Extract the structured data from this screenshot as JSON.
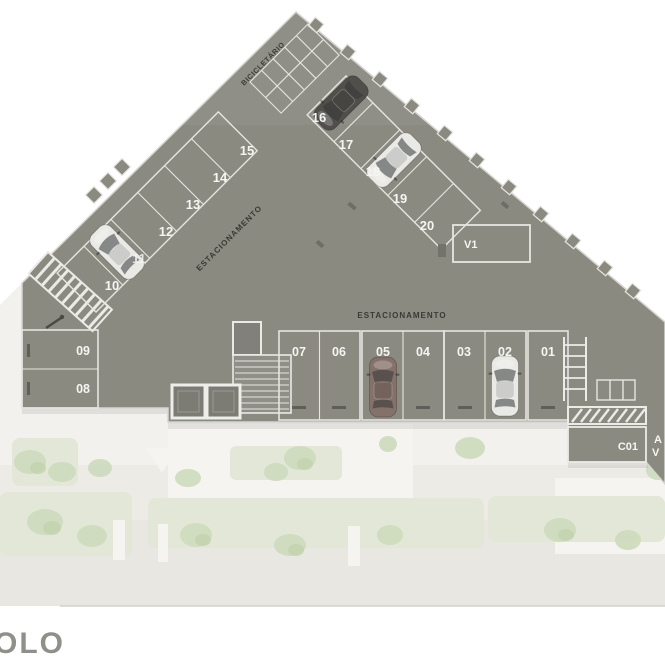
{
  "plan": {
    "caption_partial": "OLO",
    "labels": {
      "parking_diagonal": "ESTACIONAMENTO",
      "parking_horizontal": "ESTACIONAMENTO",
      "bike_storage": "BICICLETÁRIO",
      "v1": "V1",
      "c01": "C01",
      "edge_partial_line1": "A",
      "edge_partial_line2": "V"
    },
    "stalls": {
      "bottom_row": [
        "07",
        "06",
        "05",
        "04",
        "03",
        "02",
        "01"
      ],
      "left_block": [
        "09",
        "08"
      ],
      "left_diagonal": [
        "10",
        "11",
        "12",
        "13",
        "14",
        "15"
      ],
      "right_diagonal": [
        "16",
        "17",
        "18",
        "19",
        "20"
      ]
    }
  },
  "colors": {
    "deck": "#8b8a81",
    "deck_dark": "#7c7b74",
    "line": "#e6e5e0",
    "ink": "#3a3a35",
    "text_white": "#f5f5f2",
    "caption": "#90908a",
    "sidewalk": "#f2f1ed",
    "garden": "#ecebe6",
    "garden_low": "#e8e7e1",
    "plaza": "#f5f4f0",
    "hedge": "#e2e7d7",
    "tree": "#cedbbd",
    "tree2": "#c2d1ac",
    "car_white": "#e9e9e6",
    "car_dark": "#504f4b",
    "car_brown": "#847169"
  }
}
